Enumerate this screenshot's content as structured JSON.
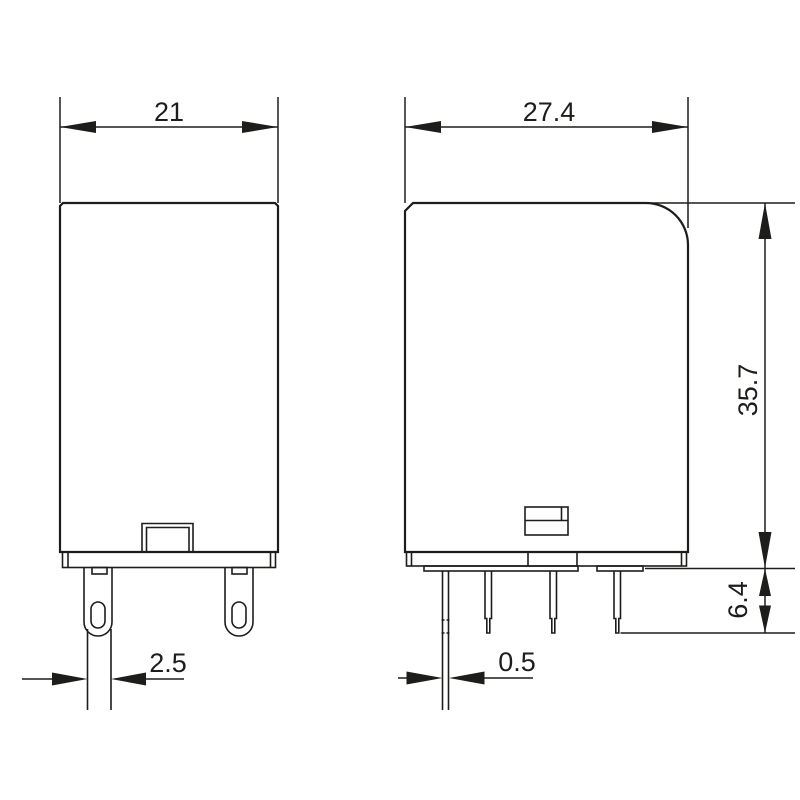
{
  "drawing": {
    "kind": "relay-dimension-drawing",
    "views": {
      "front_view": {
        "description_labels": []
      },
      "side_view": {
        "description_labels": []
      }
    }
  },
  "dims": {
    "front_width": "21",
    "front_pin_width": "2.5",
    "side_width": "27.4",
    "body_height": "35.7",
    "pin_length": "6.4",
    "side_pin_thickness": "0.5"
  },
  "colors": {
    "line": "#1d1d1b",
    "background": "#ffffff"
  }
}
